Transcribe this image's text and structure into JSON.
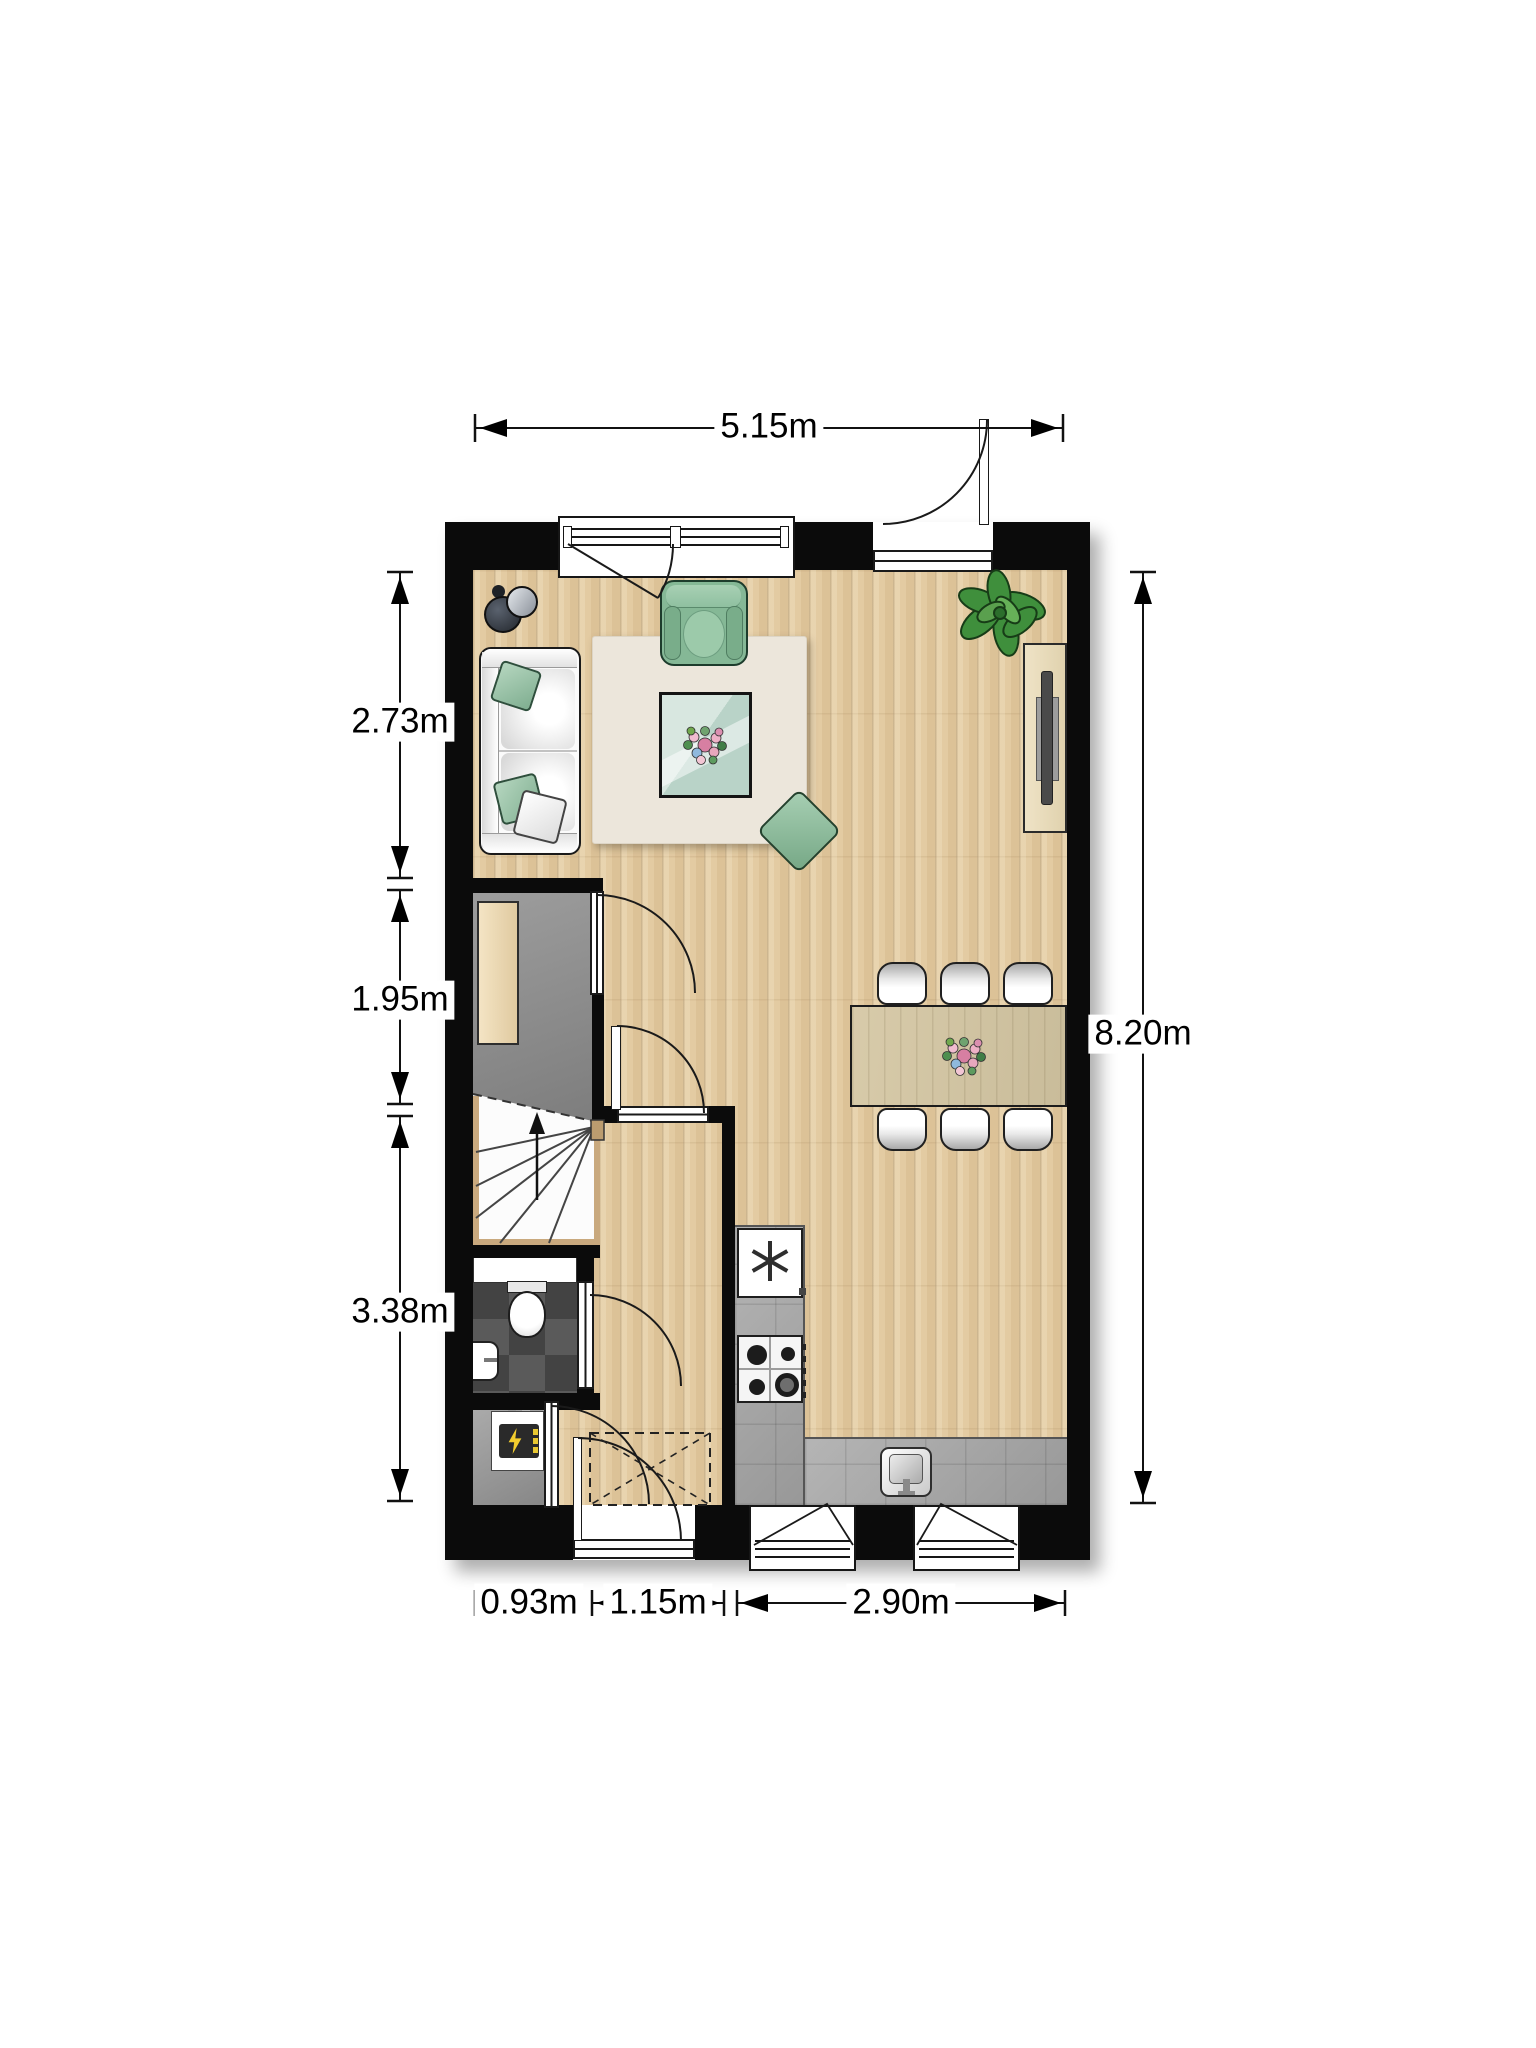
{
  "title": "ground floor plan",
  "dimensions": {
    "top": "5.15m",
    "right": "8.20m",
    "left": [
      "2.73m",
      "1.95m",
      "3.38m"
    ],
    "bottom": [
      "0.93m",
      "1.15m",
      "2.90m"
    ]
  },
  "rooms": [
    "living-dining-room",
    "entry-hall",
    "staircase",
    "toilet",
    "meter-closet",
    "kitchen"
  ],
  "furniture": [
    "sofa",
    "floor-lamp",
    "armchair",
    "coffee-table",
    "rug",
    "pouf",
    "plant",
    "tv-cabinet",
    "dining-table",
    "six-dining-chairs",
    "hall-closet",
    "refrigerator",
    "gas-hob",
    "kitchen-sink",
    "toilet-bowl",
    "hand-basin",
    "meter-box"
  ],
  "icons": {
    "refrigerator": "asterisk-icon",
    "meter_box": "lightning-icon",
    "stairs_direction": "up-arrow-icon"
  },
  "colors": {
    "wall": "#0b0b0b",
    "wood_floor": "#e3cba2",
    "hall_floor": "#8f8f8f",
    "toilet_tiles": "#4f4f4f",
    "counter": "#a7a7a7",
    "accent_green": "#8fc0a0",
    "rug": "#ece6db",
    "dining_table": "#d2c5a6",
    "dimension_text": "#000000"
  }
}
